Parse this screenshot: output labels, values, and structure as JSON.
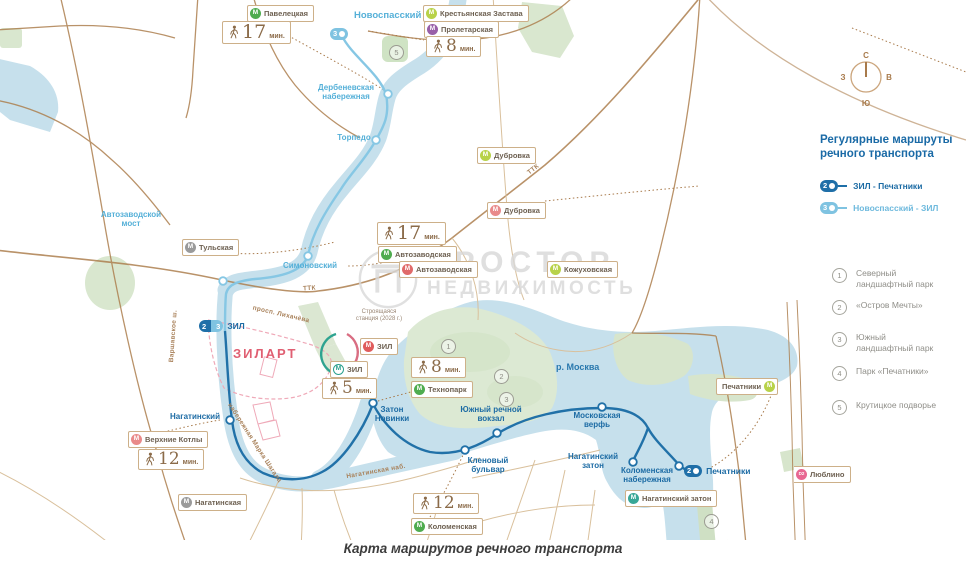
{
  "caption": "Карта маршрутов речного транспорта",
  "watermark": {
    "line1": "ПРОСТОР",
    "line2": "НЕДВИЖИМОСТЬ"
  },
  "compass": {
    "n": "С",
    "s": "Ю",
    "w": "З",
    "e": "В"
  },
  "legend": {
    "title": "Регулярные маршруты речного транспорта",
    "routes": [
      {
        "num": "2",
        "label": "ЗИЛ - Печатники"
      },
      {
        "num": "3",
        "label": "Новоспасский - ЗИЛ"
      }
    ],
    "pois": [
      {
        "num": "1",
        "label": "Северный ландшафтный парк"
      },
      {
        "num": "2",
        "label": "«Остров Мечты»"
      },
      {
        "num": "3",
        "label": "Южный ландшафтный парк"
      },
      {
        "num": "4",
        "label": "Парк «Печатники»"
      },
      {
        "num": "5",
        "label": "Крутицкое подворье"
      }
    ]
  },
  "map_markers": {
    "m1": "1",
    "m2": "2",
    "m3": "3",
    "m4": "4",
    "m5": "5"
  },
  "badges": {
    "zil_left": "2",
    "zil_right": "3",
    "zil_label": "ЗИЛ",
    "novospassky": "3",
    "pechatniki_num": "2",
    "pechatniki_label": "Печатники"
  },
  "piers": {
    "novospassky": "Новоспасский",
    "derbenevskaya": "Дербеневская набережная",
    "torpedo": "Торпедо",
    "simonovsky": "Симоновский",
    "avtozavodsky_most": "Автозаводской мост",
    "nagatinsky": "Нагатинский",
    "zaton_novinki": "Затон Новинки",
    "yuzhny_vokzal": "Южный речной вокзал",
    "moskovskaya_verf": "Московская верфь",
    "klenovy_bulvar": "Кленовый бульвар",
    "nagatinsky_zaton": "Нагатинский затон",
    "kolomenskaya_nab": "Коломенская набережная"
  },
  "metro": {
    "m_letter": "М",
    "paveletskaya": "Павелецкая",
    "krestyanskaya": "Крестьянская Застава",
    "proletarskaya": "Пролетарская",
    "dubrovka_lime": "Дубровка",
    "dubrovka_pink": "Дубровка",
    "tulskaya": "Тульская",
    "avtozavodskaya_metro": "Автозаводская",
    "avtozavodskaya_mcc": "Автозаводская",
    "kozhukhovskaya": "Кожуховская",
    "zil_mcc": "ЗИЛ",
    "zil_metro": "ЗИЛ",
    "tekhnopark": "Технопарк",
    "verkhnie_kotly": "Верхние Котлы",
    "nagatinskaya": "Нагатинская",
    "kolomenskaya": "Коломенская",
    "nagatinsky_zaton": "Нагатинский затон",
    "pechatniki": "Печатники",
    "lyublino": "Люблино",
    "lyublino_badge": "D2"
  },
  "minutes": {
    "unit": "мин.",
    "paveletskaya": "17",
    "proletarskaya": "8",
    "avtozavodskaya": "17",
    "tekhnopark": "8",
    "zil": "5",
    "verkhnie_kotly": "12",
    "kolomenskaya": "12"
  },
  "streets": {
    "ttk": "ТТК",
    "likhacheva": "просп. Лихачёва",
    "shagala": "набережная Марка Шагала",
    "nagatinskaya_nab": "Нагатинская наб.",
    "varshavskoe": "Варшавское ш."
  },
  "labels": {
    "moskva_river": "р. Москва",
    "zilart": "ЗИЛАРТ",
    "construction": "Строящаяся станция (2028 г.)"
  },
  "colors": {
    "route2": "#1f6fa8",
    "route3": "#7fc3e1",
    "water": "#c6e0ec",
    "park": "#dce9d3",
    "road": "#ad7f4e",
    "text_dark_blue": "#1c6ba4",
    "text_light_blue": "#55b0d8",
    "zilart_pink": "#e05f72"
  }
}
